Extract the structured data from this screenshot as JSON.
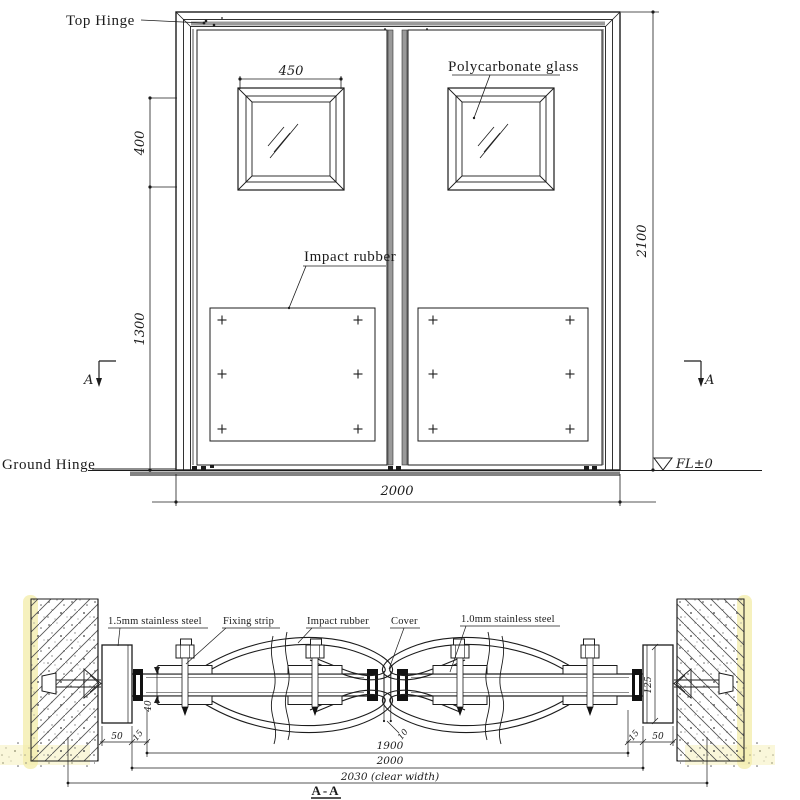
{
  "colors": {
    "line": "#1c1c1c",
    "shade_gray": "#8f8f8f",
    "stile_gray": "#9a9a9a",
    "wall_yellow": "#f4eeae"
  },
  "elevation": {
    "labels": {
      "top_hinge": "Top Hinge",
      "polycarbonate_glass": "Polycarbonate glass",
      "impact_rubber": "Impact rubber",
      "ground_hinge": "Ground Hinge",
      "level_mark": "FL±0",
      "section_letter": "A"
    },
    "dims": {
      "window_width": "450",
      "window_height": "400",
      "lower_height": "1300",
      "door_height": "2100",
      "door_width": "2000"
    }
  },
  "section": {
    "title": "A-A",
    "labels": {
      "frame_steel": "1.5mm stainless steel",
      "fixing_strip": "Fixing strip",
      "impact_rubber": "Impact rubber",
      "cover": "Cover",
      "door_steel": "1.0mm stainless steel"
    },
    "dims": {
      "leaf_thickness": "40",
      "frame_width_left": "50",
      "side_gap_left": "15",
      "center_gap": "10",
      "inner_width": "1900",
      "frame_outer_width": "2000",
      "clear_width": "2030 (clear width)",
      "post_depth": "125",
      "side_gap_right": "15",
      "frame_width_right": "50"
    }
  }
}
